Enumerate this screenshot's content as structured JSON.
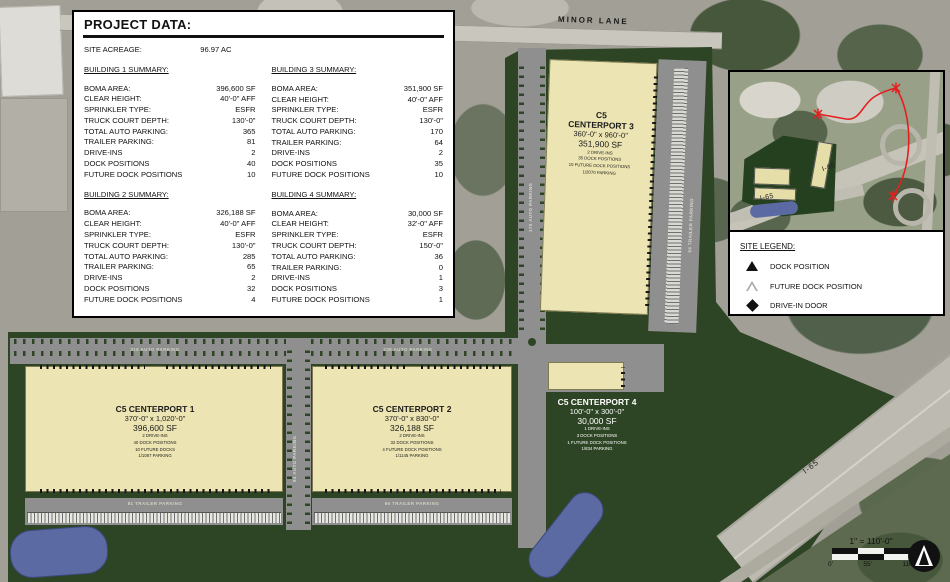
{
  "project_data": {
    "title": "PROJECT DATA:",
    "acreage": {
      "label": "SITE ACREAGE:",
      "value": "96.97 AC"
    },
    "b1": {
      "heading": "BUILDING 1 SUMMARY:",
      "rows": [
        {
          "l": "BOMA AREA:",
          "v": "396,600 SF"
        },
        {
          "l": "CLEAR HEIGHT:",
          "v": "40'-0\" AFF"
        },
        {
          "l": "SPRINKLER TYPE:",
          "v": "ESFR"
        },
        {
          "l": "TRUCK COURT DEPTH:",
          "v": "130'-0\""
        },
        {
          "l": "TOTAL AUTO PARKING:",
          "v": "365"
        },
        {
          "l": "TRAILER PARKING:",
          "v": "81"
        },
        {
          "l": "DRIVE-INS",
          "v": "2"
        },
        {
          "l": "DOCK POSITIONS",
          "v": "40"
        },
        {
          "l": "FUTURE DOCK POSITIONS",
          "v": "10"
        }
      ]
    },
    "b2": {
      "heading": "BUILDING 2 SUMMARY:",
      "rows": [
        {
          "l": "BOMA AREA:",
          "v": "326,188 SF"
        },
        {
          "l": "CLEAR HEIGHT:",
          "v": "40'-0\" AFF"
        },
        {
          "l": "SPRINKLER TYPE:",
          "v": "ESFR"
        },
        {
          "l": "TRUCK COURT DEPTH:",
          "v": "130'-0\""
        },
        {
          "l": "TOTAL AUTO PARKING:",
          "v": "285"
        },
        {
          "l": "TRAILER PARKING:",
          "v": "65"
        },
        {
          "l": "DRIVE-INS",
          "v": "2"
        },
        {
          "l": "DOCK POSITIONS",
          "v": "32"
        },
        {
          "l": "FUTURE DOCK POSITIONS",
          "v": "4"
        }
      ]
    },
    "b3": {
      "heading": "BUILDING 3 SUMMARY:",
      "rows": [
        {
          "l": "BOMA AREA:",
          "v": "351,900 SF"
        },
        {
          "l": "CLEAR HEIGHT:",
          "v": "40'-0\" AFF"
        },
        {
          "l": "SPRINKLER TYPE:",
          "v": "ESFR"
        },
        {
          "l": "TRUCK COURT DEPTH:",
          "v": "130'-0\""
        },
        {
          "l": "TOTAL AUTO PARKING:",
          "v": "170"
        },
        {
          "l": "TRAILER PARKING:",
          "v": "64"
        },
        {
          "l": "DRIVE-INS",
          "v": "2"
        },
        {
          "l": "DOCK POSITIONS",
          "v": "35"
        },
        {
          "l": "FUTURE DOCK POSITIONS",
          "v": "10"
        }
      ]
    },
    "b4": {
      "heading": "BUILDING 4 SUMMARY:",
      "rows": [
        {
          "l": "BOMA AREA:",
          "v": "30,000 SF"
        },
        {
          "l": "CLEAR HEIGHT:",
          "v": "32'-0\" AFF"
        },
        {
          "l": "SPRINKLER TYPE:",
          "v": "ESFR"
        },
        {
          "l": "TRUCK COURT DEPTH:",
          "v": "150'-0\""
        },
        {
          "l": "TOTAL AUTO PARKING:",
          "v": "36"
        },
        {
          "l": "TRAILER PARKING:",
          "v": "0"
        },
        {
          "l": "DRIVE-INS",
          "v": "1"
        },
        {
          "l": "DOCK POSITIONS",
          "v": "3"
        },
        {
          "l": "FUTURE DOCK POSITIONS",
          "v": "1"
        }
      ]
    }
  },
  "plan": {
    "minor_lane": "MINOR LANE",
    "i65": "I-65",
    "buildings": {
      "b1": {
        "name": "C5 CENTERPORT 1",
        "dims": "370'-0\" x 1,020'-0\"",
        "area": "396,600 SF",
        "d0": "2 DRIVE-INS",
        "d1": "40 DOCK POSITIONS",
        "d2": "10 FUTURE DOCKS",
        "d3": "1/1087 PARKING"
      },
      "b2": {
        "name": "C5 CENTERPORT 2",
        "dims": "370'-0\" x 830'-0\"",
        "area": "326,188 SF",
        "d0": "2 DRIVE-INS",
        "d1": "32 DOCK POSITIONS",
        "d2": "4 FUTURE DOCK POSITIONS",
        "d3": "1/1145 PARKING"
      },
      "b3": {
        "name1": "C5",
        "name2": "CENTERPORT 3",
        "dims": "360'-0\" x 960'-0\"",
        "area": "351,900 SF",
        "d0": "2 DRIVE-INS",
        "d1": "35 DOCK POSITIONS",
        "d2": "10 FUTURE DOCK POSITIONS",
        "d3": "1/2070 PARKING"
      },
      "b4": {
        "name": "C5 CENTERPORT 4",
        "dims": "100'-0\" x 300'-0\"",
        "area": "30,000 SF",
        "d0": "1 DRIVE-INS",
        "d1": "3 DOCK POSITIONS",
        "d2": "1 FUTURE DOCK POSITIONS",
        "d3": "1/834 PARKING"
      }
    },
    "parking": {
      "auto318": "318 AUTO PARKING",
      "auto238": "238 AUTO PARKING",
      "auto94": "94 AUTO PARKING",
      "auto170": "170 AUTO PARKING",
      "trailer81": "81 TRAILER PARKING",
      "trailer65": "65 TRAILER PARKING",
      "trailer64": "64 TRAILER PARKING"
    }
  },
  "inset": {
    "i65_upper": "I-65",
    "i65_lower": "I-65"
  },
  "legend": {
    "title": "SITE LEGEND:",
    "items": [
      {
        "label": "DOCK POSITION"
      },
      {
        "label": "FUTURE DOCK POSITION"
      },
      {
        "label": "DRIVE-IN DOOR"
      }
    ]
  },
  "scale_bar": {
    "title": "1\" = 110'-0\"",
    "ticks": [
      "0'",
      "55'",
      "110'"
    ]
  },
  "colors": {
    "site_green": "#2d4524",
    "building_fill": "#ece4b2",
    "pond_blue": "#5c6aa4",
    "road_gray": "#8f8f8f",
    "route_red": "#e41f1f"
  }
}
